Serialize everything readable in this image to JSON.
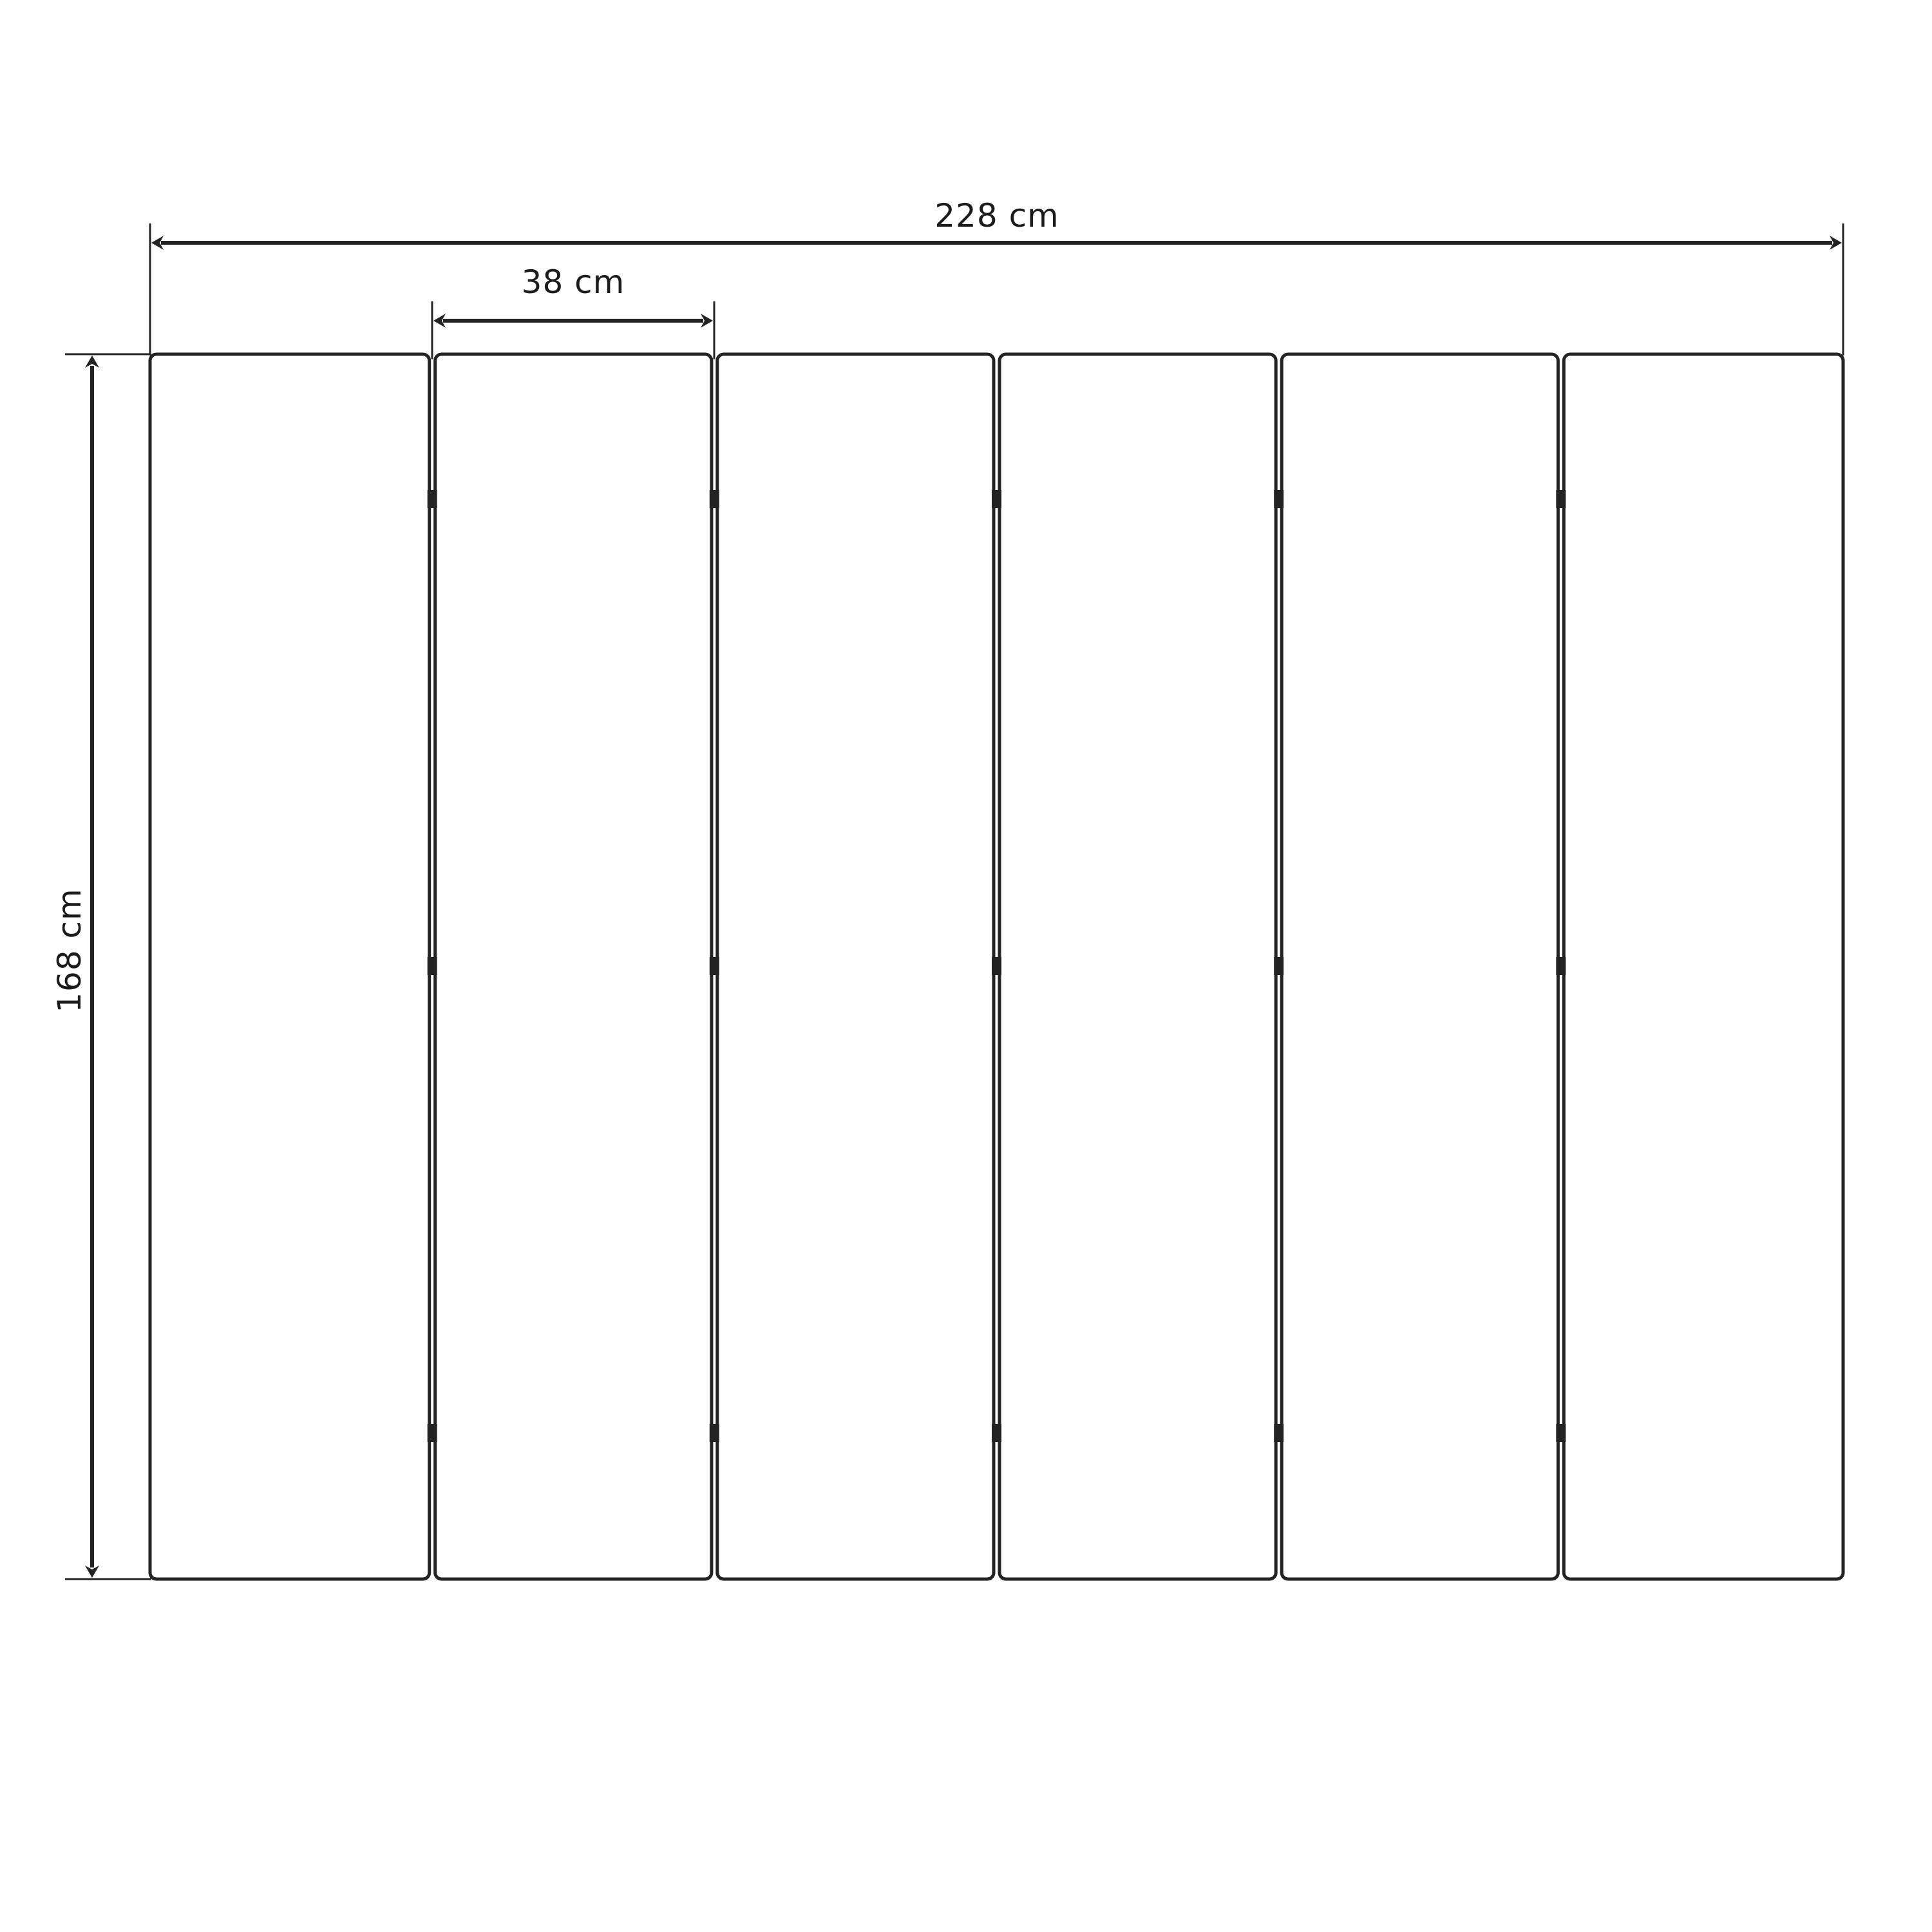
{
  "diagram": {
    "kind": "technical-dimension-drawing",
    "unit": "cm",
    "dimensions": {
      "total_width": {
        "value": 228,
        "label": "228 cm"
      },
      "panel_width": {
        "value": 38,
        "label": "38 cm"
      },
      "height": {
        "value": 168,
        "label": "168 cm"
      }
    },
    "panels": {
      "count": 6,
      "gap_count": 5,
      "connectors_per_gap": 3
    },
    "colors": {
      "line": "#232323",
      "background": "#ffffff",
      "panel_fill": "#ffffff"
    }
  }
}
